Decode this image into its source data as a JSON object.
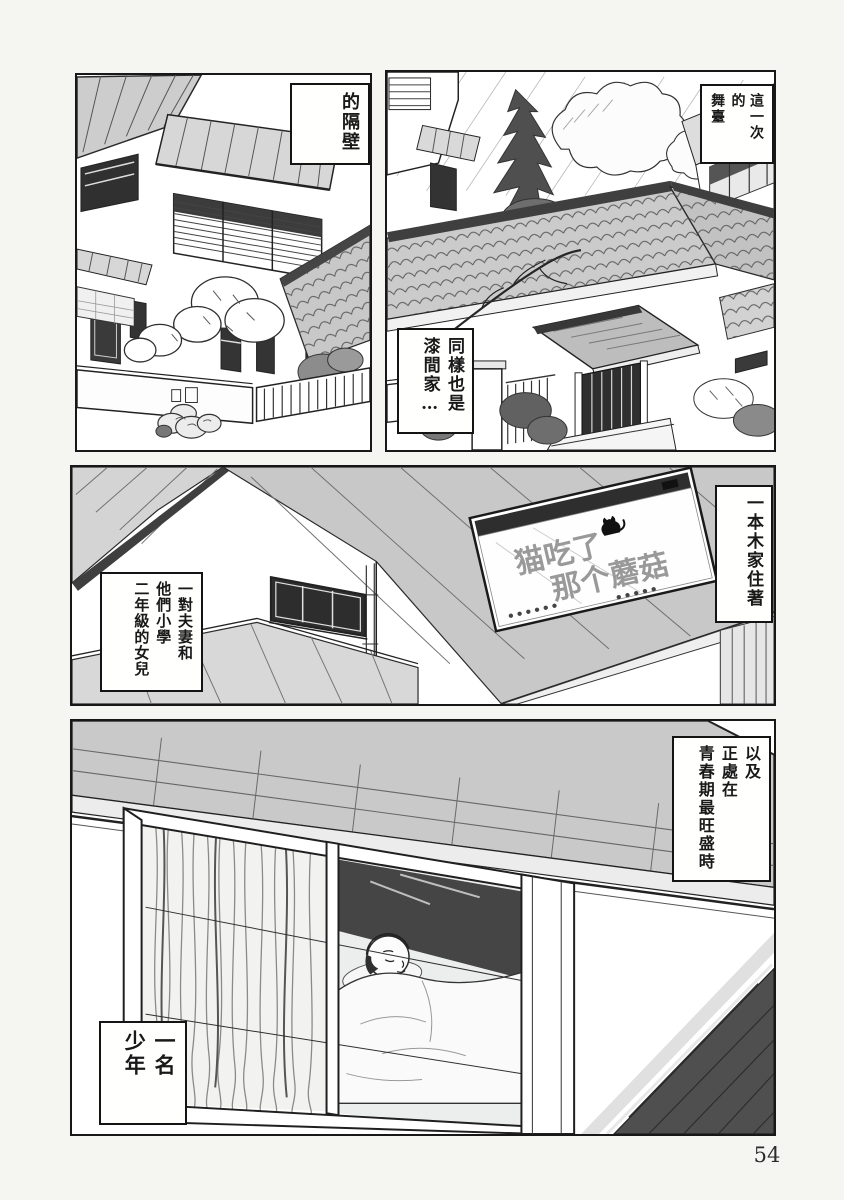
{
  "page": {
    "number": "54"
  },
  "colors": {
    "ink": "#1c1c1c",
    "paper": "#f5f5f1",
    "panel_bg": "#ffffff",
    "roof_gray": "#c9c9c9"
  },
  "captions": {
    "next_door": {
      "columns": [
        "的隔壁"
      ]
    },
    "stage": {
      "columns": [
        "這一次的",
        "舞臺"
      ]
    },
    "same_house": {
      "columns": [
        "同樣也是",
        "漆間家…"
      ]
    },
    "ipponmoku": {
      "columns": [
        "一本木家住著"
      ]
    },
    "family": {
      "columns": [
        "一對夫妻和",
        "他們小學",
        "二年級的女兒"
      ]
    },
    "puberty": {
      "columns": [
        "以及",
        "正處在",
        "青春期最旺盛時"
      ]
    },
    "boy": {
      "columns": [
        "一名",
        "少年"
      ]
    }
  },
  "sign": {
    "line1": "猫吃了",
    "line2": "那个蘑菇"
  }
}
